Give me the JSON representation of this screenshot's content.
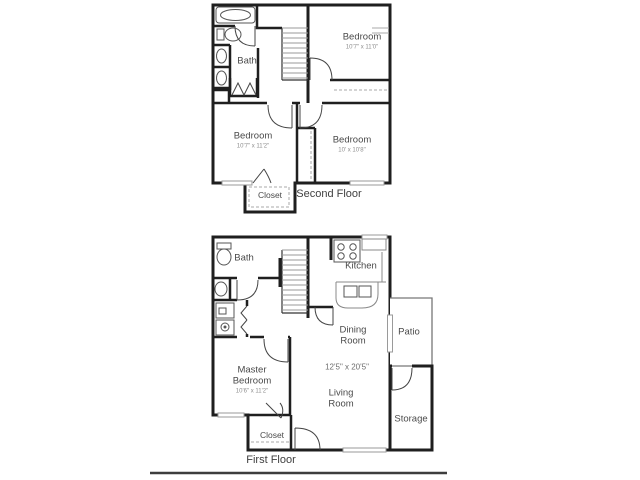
{
  "floorplan": {
    "second_floor": {
      "title": "Second Floor",
      "rooms": {
        "bath": {
          "label": "Bath"
        },
        "bedroom_top": {
          "label": "Bedroom",
          "dims": "10'7\" x 11'0\""
        },
        "bedroom_left": {
          "label": "Bedroom",
          "dims": "10'7\" x 11'2\""
        },
        "bedroom_right": {
          "label": "Bedroom",
          "dims": "10' x 10'8\""
        },
        "closet": {
          "label": "Closet"
        }
      },
      "fixtures": [
        "bathtub",
        "toilet",
        "sink",
        "sink",
        "staircase"
      ]
    },
    "first_floor": {
      "title": "First Floor",
      "unit_dims": "12'5\" x 20'5\"",
      "rooms": {
        "bath": {
          "label": "Bath"
        },
        "kitchen": {
          "label": "Kitchen"
        },
        "dining_room": {
          "label": "Dining Room"
        },
        "patio": {
          "label": "Patio"
        },
        "master_bedroom": {
          "label": "Master Bedroom",
          "dims": "10'6\" x 11'2\""
        },
        "living_room": {
          "label": "Living Room"
        },
        "storage": {
          "label": "Storage"
        },
        "closet": {
          "label": "Closet"
        }
      },
      "fixtures": [
        "toilet",
        "sink",
        "washer",
        "dryer",
        "stove",
        "kitchen-sink",
        "staircase"
      ]
    },
    "colors": {
      "wall": "#1f1f1f",
      "fixture": "#555555",
      "window": "#9a9a9a",
      "text": "#4a4a4a",
      "dim_text": "#8e8e8e"
    }
  }
}
